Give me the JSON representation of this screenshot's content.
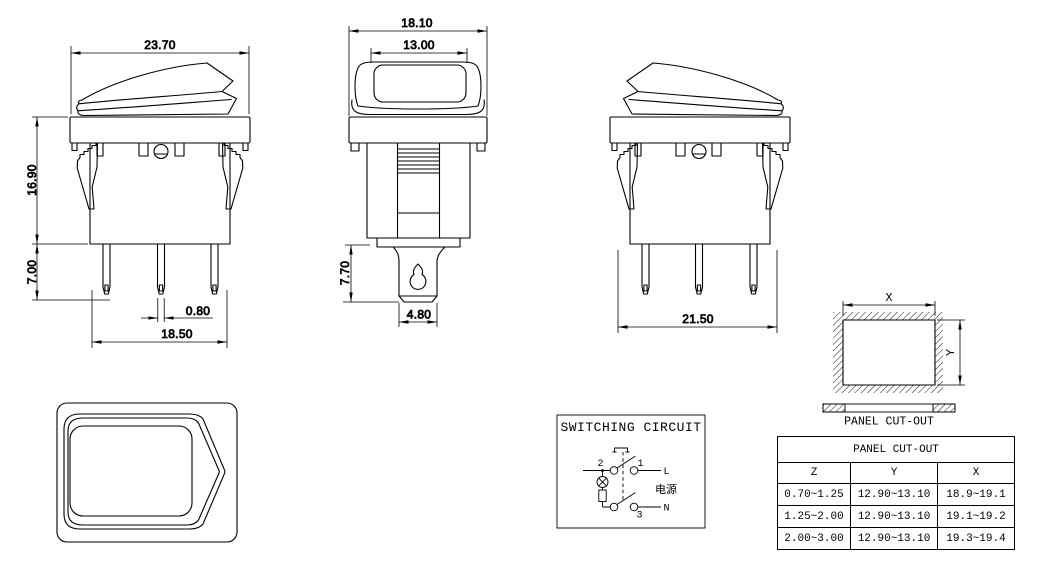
{
  "views": {
    "front_view": {
      "dim_top_width": "23.70",
      "dim_upper_height": "16.90",
      "dim_lower_height": "7.00",
      "dim_pin_thickness": "0.80",
      "dim_pin_span": "18.50"
    },
    "side_view": {
      "dim_outer_width": "18.10",
      "dim_inner_width": "13.00",
      "dim_terminal_length": "7.70",
      "dim_terminal_width": "4.80"
    },
    "rear_view": {
      "dim_body_width": "21.50"
    }
  },
  "circuit": {
    "title": "SWITCHING CIRCUIT",
    "terminal_2": "2",
    "terminal_1": "1",
    "terminal_3": "3",
    "line_label": "L",
    "neutral_label": "N",
    "power_label": "电源"
  },
  "panel_cutout": {
    "x_label": "X",
    "y_label": "Y",
    "caption": "PANEL CUT-OUT"
  },
  "table": {
    "title": "PANEL CUT-OUT",
    "columns": [
      "Z",
      "Y",
      "X"
    ],
    "rows": [
      [
        "0.70~1.25",
        "12.90~13.10",
        "18.9~19.1"
      ],
      [
        "1.25~2.00",
        "12.90~13.10",
        "19.1~19.2"
      ],
      [
        "2.00~3.00",
        "12.90~13.10",
        "19.3~19.4"
      ]
    ]
  }
}
